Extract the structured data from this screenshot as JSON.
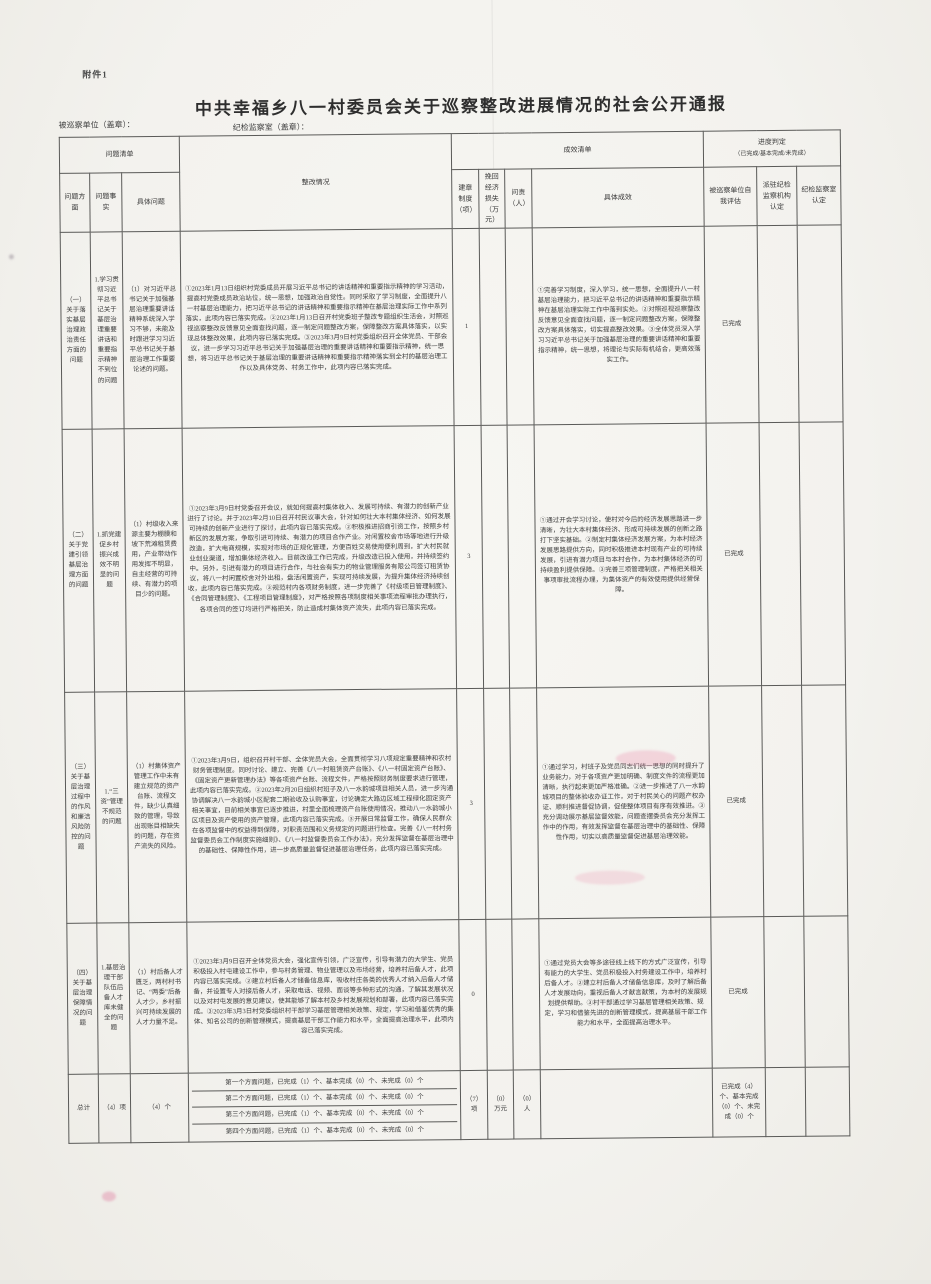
{
  "page": {
    "attachment_label": "附件1",
    "title": "中共幸福乡八一村委员会关于巡察整改进展情况的社会公开通报",
    "inspected_unit_label": "被巡察单位（盖章）：",
    "supervision_office_label": "纪检监察室（盖章）："
  },
  "table": {
    "headers": {
      "problem_list": "问题清单",
      "problem_aspect": "问题方面",
      "problem_fact": "问题事实",
      "specific_problem": "具体问题",
      "rectification": "整改情况",
      "effect_list": "成效清单",
      "rules_built": "建章制度（项）",
      "recovered_loss": "挽回经济损失（万元）",
      "accountability": "问责（人）",
      "specific_effect": "具体成效",
      "progress_judgment": "进度判定",
      "progress_judgment_note": "（已完成/基本完成/未完成）",
      "self_assessment": "被巡察单位自我评估",
      "agency_confirm": "派驻纪检监察机构认定",
      "office_confirm": "纪检监察室认定"
    },
    "rows": [
      {
        "aspect": "（一）关于落实基层治理政治责任方面的问题",
        "fact": "1.学习贯彻习近平总书记关于基层治理重要讲话和重要指示精神不到位的问题",
        "problem": "（1）对习近平总书记关于加强基层治理重要讲话精神系统深入学习不够，未能及时跟进学习习近平总书记关于基层治理工作重要论述的问题。",
        "rectification": "①2023年1月13日组织村党委成员开展习近平总书记的讲话精神和重要指示精神的学习活动，提高村党委成员政治站位，统一思想，加强政治自觉性。同时采取了学习制度，全面提升八一村基层治理能力，把习近平总书记的讲话精神和重要指示精神在基层治理实际工作中系列落实，此项内容已落实完成。②2023年1月13日召开村党委班子整改专题组织生活会，对照巡视巡察整改反馈意见全面查找问题，逐一制定问题整改方案，保障整改方案具体落实，以实现总体整改效果，此项内容已落实完成。③2023年3月9日村党委组织召开全体党员、干部会议，进一步学习习近平总书记关于加强基层治理的重要讲话精神和重要指示精神，统一思想，将习近平总书记关于基层治理的重要讲话精神和重要指示精神落实到全村的基层治理工作以及具体党务、村务工作中，此项内容已落实完成。",
        "rules": "1",
        "loss": "",
        "accountability": "",
        "effect": "①完善学习制度，深入学习，统一思想，全面提升八一村基层治理能力，把习近平总书记的讲话精神和重要指示精神在基层治理实际工作中落到实处。②对照巡视巡察整改反馈意见全面查找问题，逐一制定问题整改方案，保障整改方案具体落实，切实提高整改效果。③全体党员深入学习习近平总书记关于加强基层治理的重要讲话精神和重要指示精神，统一思想，将理论与实际有机结合，更高效落实工作。",
        "self_assessment": "已完成",
        "agency_confirm": "",
        "office_confirm": ""
      },
      {
        "aspect": "（二）关于党建引领基层治理方面的问题",
        "fact": "1.抓党建促乡村振兴成效不明显的问题",
        "problem": "（1）村级收入来源主要为棚膜和坡下荒滩租赁费用，产业带动作用发挥不明显，自主经营的可持续、有潜力的项目少的问题。",
        "rectification": "①2023年3月9日村党委召开会议，就如何提高村集体收入、发展可持续、有潜力的创新产业进行了讨论。并于2023年2月10日召开村民议事大会，针对如何壮大本村集体经济、如何发展可持续的创新产业进行了探讨，此项内容已落实完成。②积极推进招商引资工作，按照乡村新区的发展方案，争取引进可持续、有潜力的项目合作产业。对闲置校舍市场等地进行升级改造，扩大电商规模，实现对市场的正规化管理，方便百姓交易使用便利周到，扩大村民就业创业渠道，增加集体经济收入。目前改造工作已完成，升级改造已投入使用，并持续签约中。另外，引进有潜力的项目进行合作，与社会有实力的物业管理服务有限公司签订租赁协议，将八一村闲置校舍对外出租，盘活闲置资产，实现可持续发展，为提升集体经济持续创收，此项内容已落实完成。③规范村内各项财务制度，进一步完善了《村级项目管理制度》、《合同管理制度》、《工程项目管理制度》，对严格按照各项制度相关事项流程审批办理执行，各项合同的签订均进行严格把关，防止造成村集体资产流失，此项内容已落实完成。",
        "rules": "3",
        "loss": "",
        "accountability": "",
        "effect": "①通过开会学习讨论，使村对今后的经济发展思路进一步清晰，为壮大本村集体经济、形成可持续发展的创新之路打下坚实基础。②制定村集体经济发展方案，为本村经济发展思路提供方向，同时积极推进本村现有产业的可持续发展，引进有潜力项目与本村合作，为本村集体经济的可持续盈利提供保障。③完善三项管理制度，严格把关相关事项审批流程办理，为集体资产的有效使用提供经营保障。",
        "self_assessment": "已完成",
        "agency_confirm": "",
        "office_confirm": ""
      },
      {
        "aspect": "（三）关于基层治理过程中的作风和廉洁风险防控的问题",
        "fact": "1.“三资”管理不规范的问题",
        "problem": "（1）村集体资产管理工作中未有建立规范的资产台账、流程文件，缺少认真细致的管理，导致出现账目相缺失的问题，存在资产流失的风险。",
        "rectification": "①2023年3月9日，组织召开村干部、全体党员大会，全面贯彻学习八项规定重要精神和农村财务管理制度。同时讨论、建立、完善《八一村租赁资产台账》、《八一村固定资产台账》、《固定资产更新管理办法》等各项资产台账、流程文件，严格按照财务制度要求进行管理，此项内容已落实完成。②2023年2月20日组织村班子及八一水韵城项目相关人员，进一步沟通协调解决八一水韵城小区配套二期验收及认购事宜，讨论确定大路边区域工程绿化固定资产相关事宜，目前相关事宜已逐步推进，村里全面梳理资产台账使用情况，推动八一水韵城小区项目及资产使用的资产管理，此项内容已落实完成。③开展日常监督工作，确保人民群众在各项监督中的权益得到保障，对职责范围和义务规定的问题进行检查。完善《八一村村务监督委员会工作制度实施细则》、《八一村监督委员会工作办法》，充分发挥监督在基层治理中的基础性、保障性作用，进一步高质量监督促进基层治理任务，此项内容已落实完成。",
        "rules": "3",
        "loss": "",
        "accountability": "",
        "effect": "①通过学习，村班子及党员同志们统一思想的同时提升了业务能力，对于各项资产更加明确、制度文件的流程更加清晰，执行起来更加严格准确。②进一步推进了八一水韵城项目的整体验收办证工作，对于村民关心的问题产权办证、顺利推进督促协调，促使整体项目有序有效推进。③充分调动展示基层监督效能，问题查摆委员会充分发挥工作中的作用，有效发挥监督在基层治理中的基础性、保障性作用，切实以高质量监督促进基层治理效能。",
        "self_assessment": "已完成",
        "agency_confirm": "",
        "office_confirm": ""
      },
      {
        "aspect": "（四）关于基层治理保障情况的问题",
        "fact": "1.基层治理干部队伍后备人才库未健全的问题",
        "problem": "（1）村后备人才匮乏，两村村书记、“两委”后备人才少，乡村振兴可持续发展的人才力量不足。",
        "rectification": "①2023年3月9日召开全体党员大会，强化宣传引领，广泛宣传，引导有潜力的大学生、党员积极投入村屯建设工作中，参与村务管理、物业管理以及市场经营，培养村后备人才，此项内容已落实完成。②建立村后备人才储备信息库，吸收村庄各类的优秀人才纳入后备人才储备，并设置专人对接后备人才，采取电话、视频、面谈等多种形式的沟通，了解其发展状况以及对村屯发展的意见建议，使其能够了解本村及乡村发展规划和部署，此项内容已落实完成。③2023年3月3日村党委组织村干部学习基层管理相关政策、规定，学习和借鉴优秀的集体、知名公司的创新管理模式，提高基层干部工作能力和水平，全面提高治理水平，此项内容已落实完成。",
        "rules": "0",
        "loss": "",
        "accountability": "",
        "effect": "①通过党员大会等多途径线上线下的方式广泛宣传，引导有能力的大学生、党员积极投入村务建设工作中，培养村后备人才。②建立村后备人才储备信息库，及时了解后备人才发展动向，重视后备人才献言献策，为本村的发展规划提供帮助。③村干部通过学习基层管理相关政策、规定，学习和借鉴先进的创新管理模式，提高基层干部工作能力和水平，全面提高治理水平。",
        "self_assessment": "已完成",
        "agency_confirm": "",
        "office_confirm": ""
      }
    ],
    "total": {
      "label": "总计",
      "aspects": "（4）项",
      "problems": "（4）个",
      "lines": [
        "第一个方面问题，已完成（1）个、基本完成（0）个、未完成（0）个",
        "第二个方面问题，已完成（1）个、基本完成（0）个、未完成（0）个",
        "第三个方面问题，已完成（1）个、基本完成（0）个、未完成（0）个",
        "第四个方面问题，已完成（1）个、基本完成（0）个、未完成（0）个"
      ],
      "rules": "（7）项",
      "loss": "（0）万元",
      "accountability": "（0）人",
      "effect": "",
      "self_assessment": "已完成（4）个、基本完成（0）个、未完成（0）个",
      "agency_confirm": "",
      "office_confirm": ""
    }
  }
}
